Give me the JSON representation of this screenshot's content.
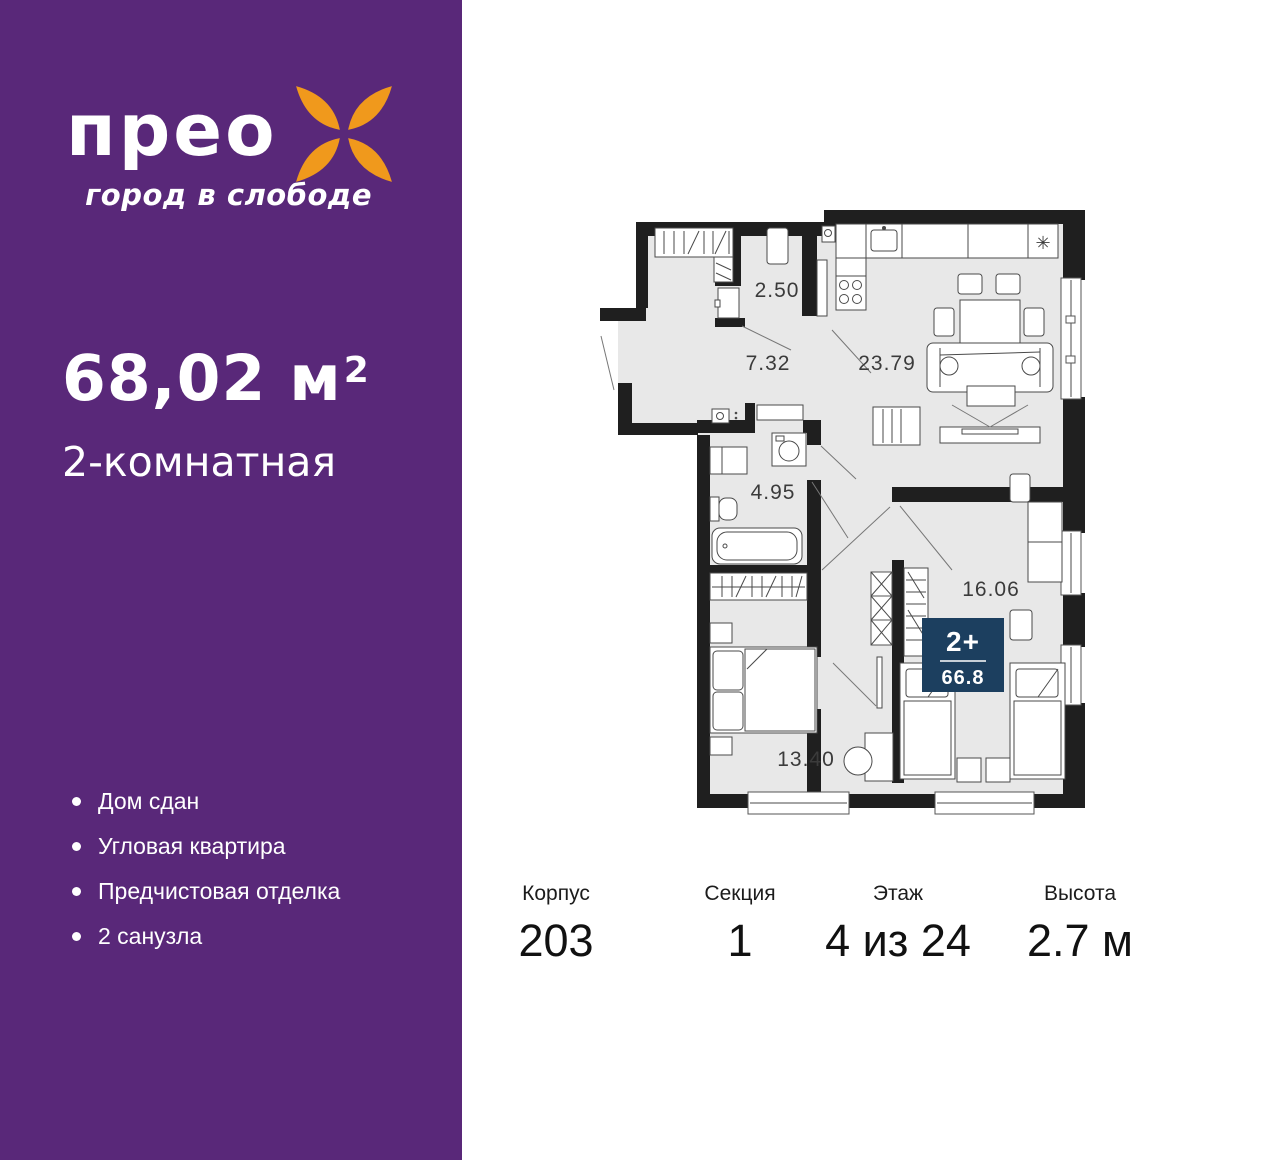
{
  "sidebar": {
    "background_color": "#592879",
    "brand": {
      "name": "прео",
      "tagline": "город в слободе",
      "flower_color": "#F0991C"
    },
    "area": {
      "value": "68,02 м",
      "superscript": "2"
    },
    "apartment_type": "2-комнатная",
    "features": [
      "Дом сдан",
      "Угловая квартира",
      "Предчистовая отделка",
      "2 санузла"
    ]
  },
  "floorplan": {
    "wall_color": "#1F1F1F",
    "floor_color": "#E8E8E8",
    "rooms": [
      {
        "name": "closet",
        "area": "2.50"
      },
      {
        "name": "hallway",
        "area": "7.32"
      },
      {
        "name": "kitchen-living-room",
        "area": "23.79"
      },
      {
        "name": "bathroom",
        "area": "4.95"
      },
      {
        "name": "bedroom-right",
        "area": "16.06"
      },
      {
        "name": "bedroom-left",
        "area": "13.40"
      }
    ],
    "badge": {
      "rooms_label": "2+",
      "total_area": "66.8",
      "color": "#1C3F5F"
    },
    "fridge_symbol": "✳"
  },
  "details": [
    {
      "label": "Корпус",
      "value": "203"
    },
    {
      "label": "Секция",
      "value": "1"
    },
    {
      "label": "Этаж",
      "value": "4 из 24"
    },
    {
      "label": "Высота",
      "value": "2.7 м"
    }
  ]
}
